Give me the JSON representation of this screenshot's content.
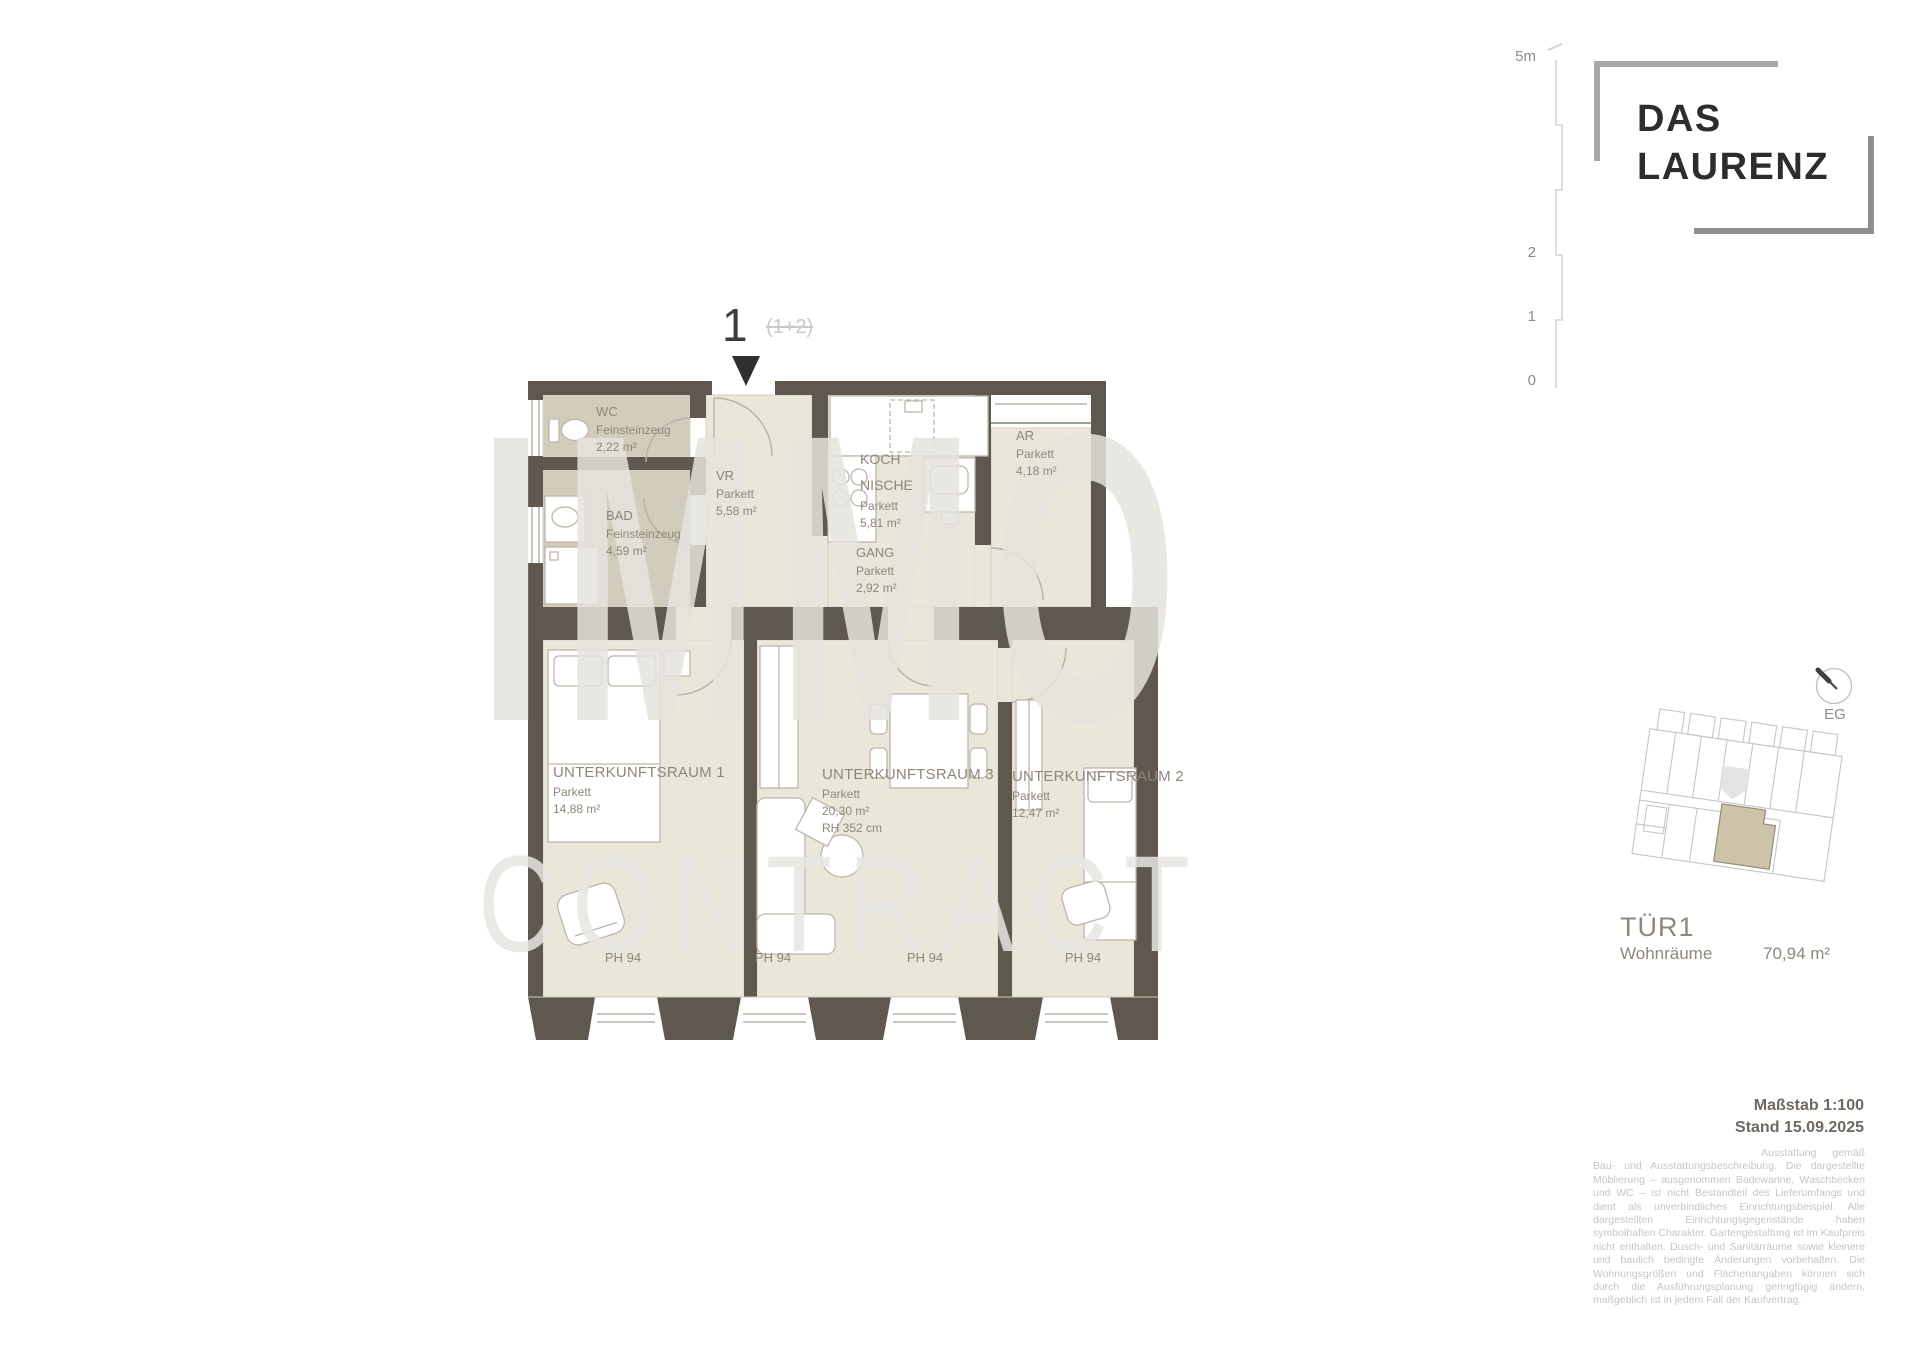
{
  "branding": {
    "line1": "DAS",
    "line2": "LAURENZ"
  },
  "ruler_labels": [
    "5m",
    "2",
    "1",
    "0"
  ],
  "entrance": {
    "number": "1",
    "strikethrough": "(1+2)"
  },
  "watermark": {
    "line1": "IMMO",
    "line2": "CONTRACT"
  },
  "rooms": [
    {
      "name": "WC",
      "floor": "Feinsteinzeug",
      "area": "2,22 m²"
    },
    {
      "name": "BAD",
      "floor": "Feinsteinzeug",
      "area": "4,59 m²"
    },
    {
      "name": "VR",
      "floor": "Parkett",
      "area": "5,58 m²"
    },
    {
      "name": "KOCH NISCHE",
      "floor": "Parkett",
      "area": "5,81 m²"
    },
    {
      "name": "GANG",
      "floor": "Parkett",
      "area": "2,92 m²"
    },
    {
      "name": "AR",
      "floor": "Parkett",
      "area": "4,18 m²"
    },
    {
      "name": "UNTERKUNFTSRAUM 1",
      "floor": "Parkett",
      "area": "14,88 m²"
    },
    {
      "name": "UNTERKUNFTSRAUM 3",
      "floor": "Parkett",
      "area": "20,30 m²",
      "note": "RH  352 cm"
    },
    {
      "name": "UNTERKUNFTSRAUM 2",
      "floor": "Parkett",
      "area": "12,47 m²"
    }
  ],
  "sill_labels": [
    "PH 94",
    "PH 94",
    "PH 94",
    "PH 94"
  ],
  "keyplan": {
    "level": "EG"
  },
  "unit": {
    "id": "TÜR1",
    "label": "Wohnräume",
    "area": "70,94 m²"
  },
  "footer": {
    "scale": "Maßstab 1:100",
    "date": "Stand 15.09.2025",
    "disclaimer": "Ausstattung gemäß Bau- und Ausstattungsbeschreibung. Die dargestellte Möblierung – ausgenommen Badewanne, Waschbecken und WC – ist nicht Bestandteil des Lieferumfangs und dient als unverbindliches Einrichtungsbeispiel. Alle dargestellten Einrichtungsgegenstände haben symbolhaften Charakter. Gartengestaltung ist im Kaufpreis nicht enthalten. Dusch- und Sanitärräume sowie kleinere und baulich bedingte Änderungen vorbehalten. Die Wohnungsgrößen und Flächenangaben können sich durch die Ausführungsplanung geringfügig ändern, maßgeblich ist in jedem Fall der Kaufvertrag."
  },
  "colors": {
    "wall": "#5e584f",
    "floor_light": "#eae6da",
    "floor_wet": "#d2ccbc",
    "highlight_unit": "#ccc3a9"
  }
}
